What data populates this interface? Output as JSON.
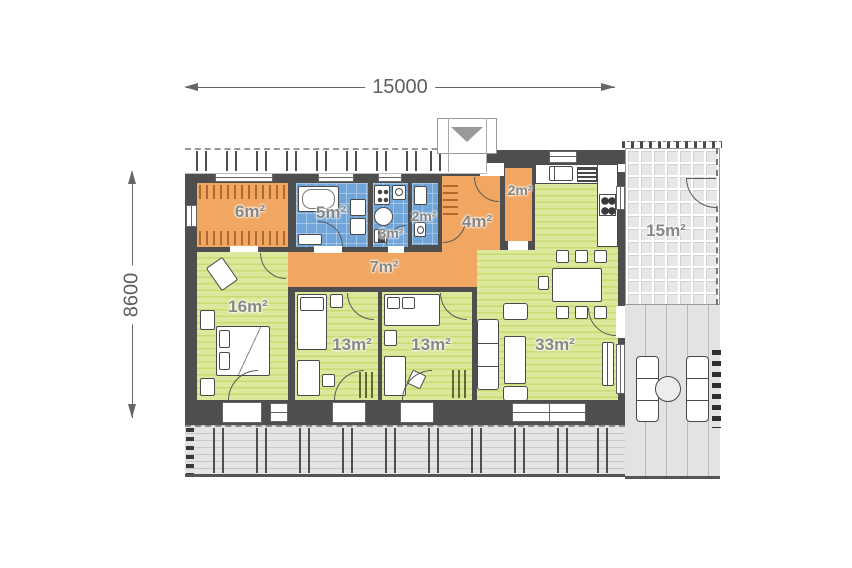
{
  "plan_title": "single-storey house floor plan",
  "dimensions": {
    "overall_width": "15000",
    "overall_height": "8600"
  },
  "rooms": [
    {
      "id": "wardrobe",
      "label": "6m²",
      "type": "wardrobe-closet",
      "color": "#F1A662"
    },
    {
      "id": "bathroom",
      "label": "5m²",
      "type": "bathroom",
      "color": "#6FA5D8"
    },
    {
      "id": "utility",
      "label": "3m²",
      "type": "utility-room",
      "color": "#6FA5D8"
    },
    {
      "id": "wc",
      "label": "2m²",
      "type": "wc",
      "color": "#6FA5D8"
    },
    {
      "id": "entry-hall",
      "label": "4m²",
      "type": "entry-hall",
      "color": "#F1A662"
    },
    {
      "id": "pantry",
      "label": "2m²",
      "type": "pantry-closet",
      "color": "#F1A662"
    },
    {
      "id": "corridor",
      "label": "7m²",
      "type": "corridor",
      "color": "#F1A662"
    },
    {
      "id": "bedroom-1",
      "label": "16m²",
      "type": "bedroom",
      "color": "#D9E68F"
    },
    {
      "id": "bedroom-2",
      "label": "13m²",
      "type": "bedroom",
      "color": "#D9E68F"
    },
    {
      "id": "bedroom-3",
      "label": "13m²",
      "type": "bedroom",
      "color": "#D9E68F"
    },
    {
      "id": "living-room",
      "label": "33m²",
      "type": "living-kitchen",
      "color": "#D9E68F"
    },
    {
      "id": "terrace",
      "label": "15m²",
      "type": "covered-terrace",
      "color": "#E7E7E7"
    }
  ],
  "colors": {
    "wall": "#4E4E4E",
    "closet_orange": "#F1A662",
    "wet_room_blue": "#6FA5D8",
    "living_green": "#D9E68F",
    "terrace_gray": "#E7E7E7",
    "deck_gray": "#E3E3E3",
    "room_label_text": "#878787",
    "dimension_text": "#5F5F5F"
  }
}
